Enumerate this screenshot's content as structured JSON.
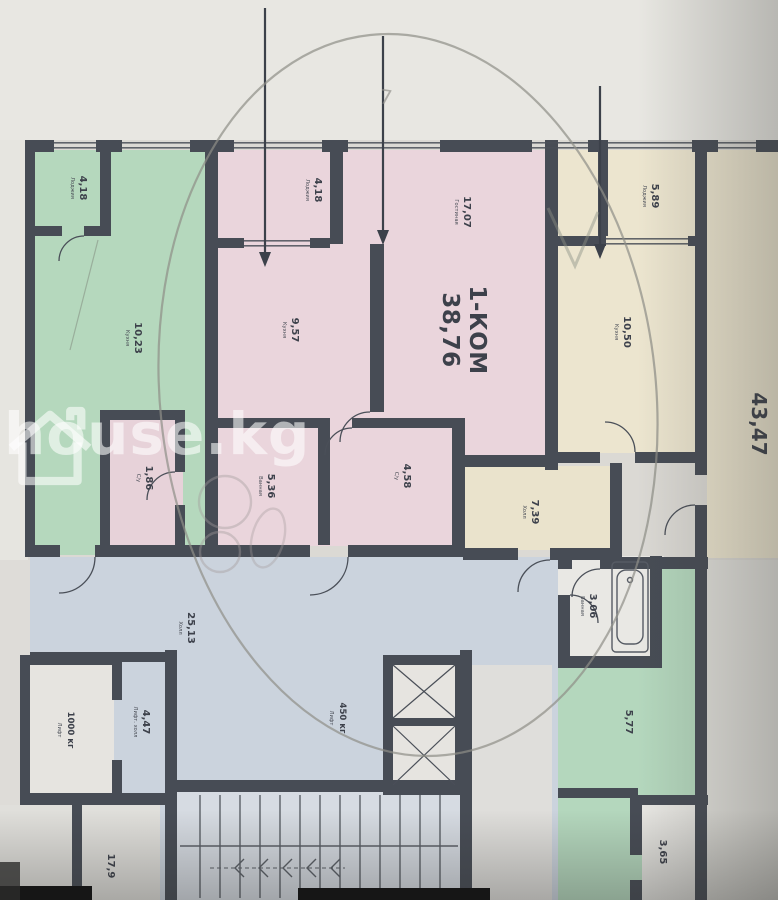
{
  "watermark": {
    "text": "house.kg"
  },
  "main_label": {
    "line1": "1-КОМ",
    "line2": "38,76"
  },
  "side_label": {
    "area": "43,47"
  },
  "pen": {
    "note": "7"
  },
  "rooms": [
    {
      "key": "loggia-left",
      "area": "4,18",
      "name": "Лоджия"
    },
    {
      "key": "kitchen-left",
      "area": "10,23",
      "name": "Кухня"
    },
    {
      "key": "wc-left",
      "area": "1,86",
      "name": "С/у"
    },
    {
      "key": "loggia-pink",
      "area": "4,18",
      "name": "Лоджия"
    },
    {
      "key": "living-pink",
      "area": "17,07",
      "name": "Гостиная"
    },
    {
      "key": "kitchen-pink",
      "area": "9,57",
      "name": "Кухня"
    },
    {
      "key": "bath-pink",
      "area": "5,36",
      "name": "Ванная"
    },
    {
      "key": "wc-pink",
      "area": "4,58",
      "name": "С/у"
    },
    {
      "key": "loggia-right",
      "area": "5,89",
      "name": "Лоджия"
    },
    {
      "key": "kitchen-right",
      "area": "10,50",
      "name": "Кухня"
    },
    {
      "key": "hall-right",
      "area": "7,39",
      "name": "Холл"
    },
    {
      "key": "bath-right",
      "area": "3,06",
      "name": "Ванная"
    },
    {
      "key": "hall-common",
      "area": "25,13",
      "name": "Холл"
    },
    {
      "key": "room-bottom-right",
      "area": "5,77",
      "name": ""
    },
    {
      "key": "wc-bottom-right",
      "area": "3,65",
      "name": ""
    },
    {
      "key": "lift-hall",
      "area": "4,47",
      "name": "Лифт. холл"
    },
    {
      "key": "stairs",
      "area": "17,9",
      "name": ""
    }
  ],
  "lifts": [
    {
      "capacity": "1000 кг",
      "name": "Лифт"
    },
    {
      "capacity": "450 кг",
      "name": "Лифт"
    }
  ],
  "colors": {
    "wall": "#474c55",
    "green": "#b5d8bd",
    "pink": "#ead5dc",
    "yellow": "#ece5cf",
    "blue": "#cbd3dd",
    "paper": "#e8e7e2"
  }
}
